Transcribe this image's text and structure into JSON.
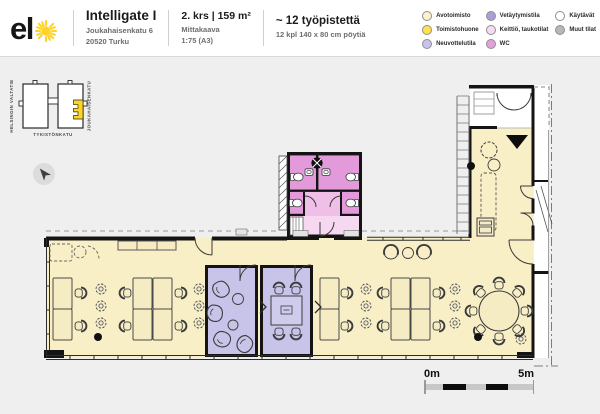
{
  "header": {
    "logo_text": "el",
    "building_name": "Intelligate I",
    "address_line1": "Joukahaisenkatu 6",
    "address_line2": "20520 Turku",
    "floor_title": "2. krs | 159 m²",
    "scale_label": "Mittakaava",
    "scale_value": "1:75 (A3)",
    "workstations_title": "~ 12 työpistettä",
    "workstations_subtitle": "12 kpl 140 x 80 cm pöytiä",
    "legend": {
      "items": [
        {
          "label": "Avotoimisto",
          "color": "#FBF2CC"
        },
        {
          "label": "Toimistohuone",
          "color": "#FFE14D"
        },
        {
          "label": "Neuvottelutila",
          "color": "#C8C4E9"
        },
        {
          "label": "Vetäytymistila",
          "color": "#A89FDB"
        },
        {
          "label": "Keittiö, taukotilat",
          "color": "#F6DCF2"
        },
        {
          "label": "WC",
          "color": "#E5A0DB"
        },
        {
          "label": "Käytävät",
          "color": "#FFFFFF"
        },
        {
          "label": "Muut tilat",
          "color": "#B8B8B8"
        }
      ]
    }
  },
  "minimap": {
    "street_left": "HELSINGIN VALTATIE",
    "street_right": "JOUKAHAISENKATU",
    "street_bottom": "TYKISTÖNKATU",
    "highlight_color": "#FFD424"
  },
  "scale_bar": {
    "start_label": "0m",
    "end_label": "5m"
  },
  "colors": {
    "open_office": "#F9EFC6",
    "meeting_room": "#C8C4E9",
    "wc_stall": "#E29ADA",
    "wc_mid": "#EFBFE8",
    "wc_lobby": "#F6D9F1",
    "corridor": "#FFFFFF",
    "accent_yellow": "#FFD424"
  }
}
